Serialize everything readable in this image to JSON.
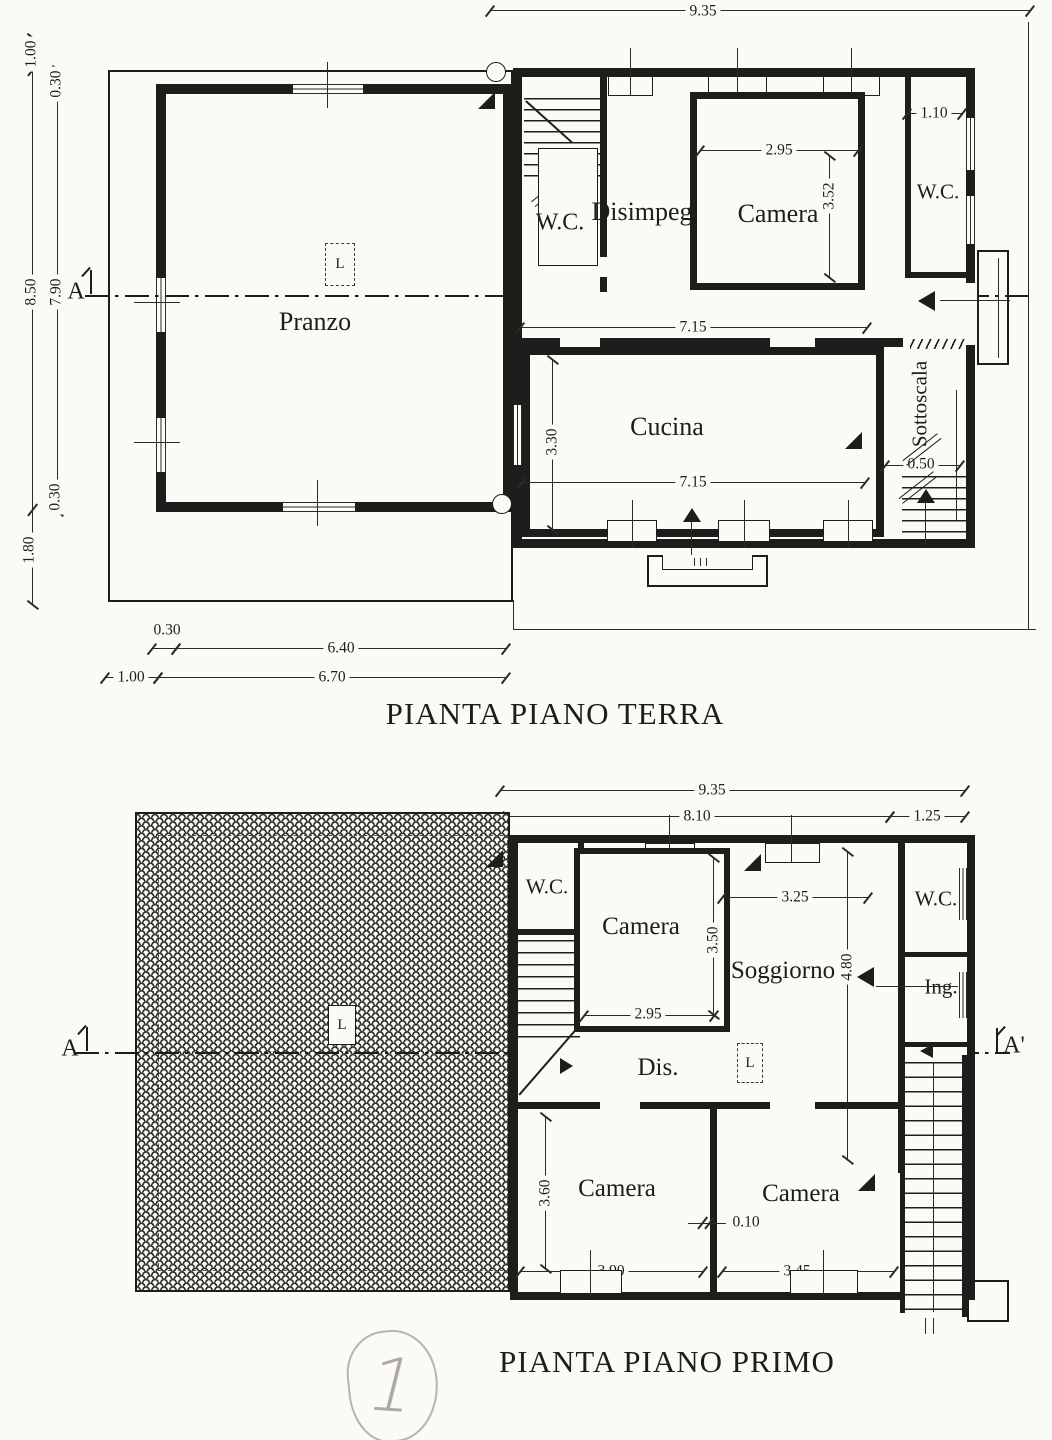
{
  "colors": {
    "ink": "#1d1d1b",
    "paper": "#fbfaf7",
    "pencil": "#b0ada7"
  },
  "gf": {
    "title": "PIANTA PIANO TERRA",
    "section_a": "A",
    "lamp": "L",
    "rooms": {
      "pranzo": "Pranzo",
      "wc1": "W.C.",
      "disimpegno": "Disimpegno",
      "camera": "Camera",
      "wc2": "W.C.",
      "cucina": "Cucina",
      "sottoscala": "Sottoscala"
    },
    "dims": {
      "top_width": "9.35",
      "left_porch": "1.00",
      "left_wall_top": "0.30",
      "left_outer": "8.50",
      "left_inner": "7.90",
      "left_wall_bottom": "0.30",
      "left_porch_bottom": "1.80",
      "camera_width": "2.95",
      "camera_height": "3.52",
      "wc_width": "1.10",
      "hall_width": "7.15",
      "cucina_height": "3.30",
      "cucina_width": "7.15",
      "sottoscala_width": "0.50",
      "bottom_wall": "0.30",
      "bottom_inner": "6.40",
      "bottom_porch": "1.00",
      "bottom_outer": "6.70"
    }
  },
  "ff": {
    "title": "PIANTA PIANO PRIMO",
    "section_a": "A",
    "section_a1": "A'",
    "roof_lamp": "L",
    "hall_lamp": "L",
    "rooms": {
      "wc1": "W.C.",
      "camera_top": "Camera",
      "soggiorno": "Soggiorno",
      "wc2": "W.C.",
      "ing": "Ing.",
      "dis": "Dis.",
      "camera_bl": "Camera",
      "camera_br": "Camera"
    },
    "dims": {
      "top_width": "9.35",
      "body_width": "8.10",
      "stair_width": "1.25",
      "soggiorno_width": "3.25",
      "camera_top_height": "3.50",
      "camera_top_width": "2.95",
      "soggiorno_height": "4.80",
      "camera_bl_height": "3.60",
      "camera_bl_width": "3.90",
      "partition": "0.10",
      "camera_br_width": "3.45"
    }
  },
  "note": {
    "sheet_number": "1"
  }
}
